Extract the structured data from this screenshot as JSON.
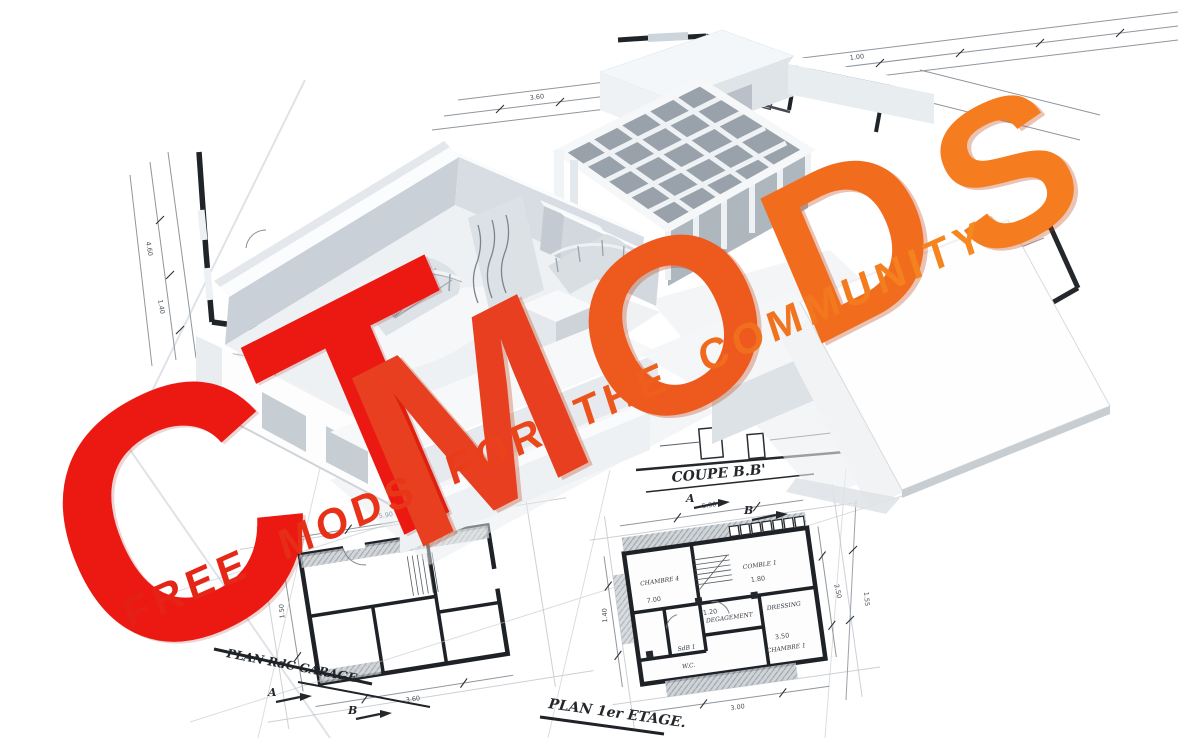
{
  "poster": {
    "title_word_1": "CT",
    "title_word_2_letters": [
      "M",
      "O",
      "D",
      "S"
    ],
    "tagline": "FREE MODS FOR THE COMMUNITY",
    "colors": {
      "title_red": "#eb1911",
      "mods_gradient": [
        "#e73f1f",
        "#ee5a1e",
        "#f26c1e",
        "#f57d1f"
      ],
      "tagline_gradient_start": "#e41f15",
      "tagline_gradient_end": "#f68a1f"
    }
  },
  "blueprints": {
    "labels": {
      "section": "COUPE B.B'",
      "floor_plan": "PLAN 1er ETAGE.",
      "garage_plan": "PLAN RdC GARAGE"
    },
    "section_markers": {
      "a": "A",
      "b": "B"
    },
    "room_labels": [
      "CHAMBRE 1",
      "CHAMBRE 4",
      "COMBLE 1",
      "DEGAGEMENT",
      "DRESSING",
      "SdB 1",
      "W.C."
    ],
    "dimension_labels": [
      "5.90",
      "3.60",
      "1.50",
      "1.80",
      "7.00",
      "1.20",
      "3.50",
      "1.00",
      "2.50",
      "1.40",
      "3.00",
      "1.55",
      "4.60"
    ]
  }
}
